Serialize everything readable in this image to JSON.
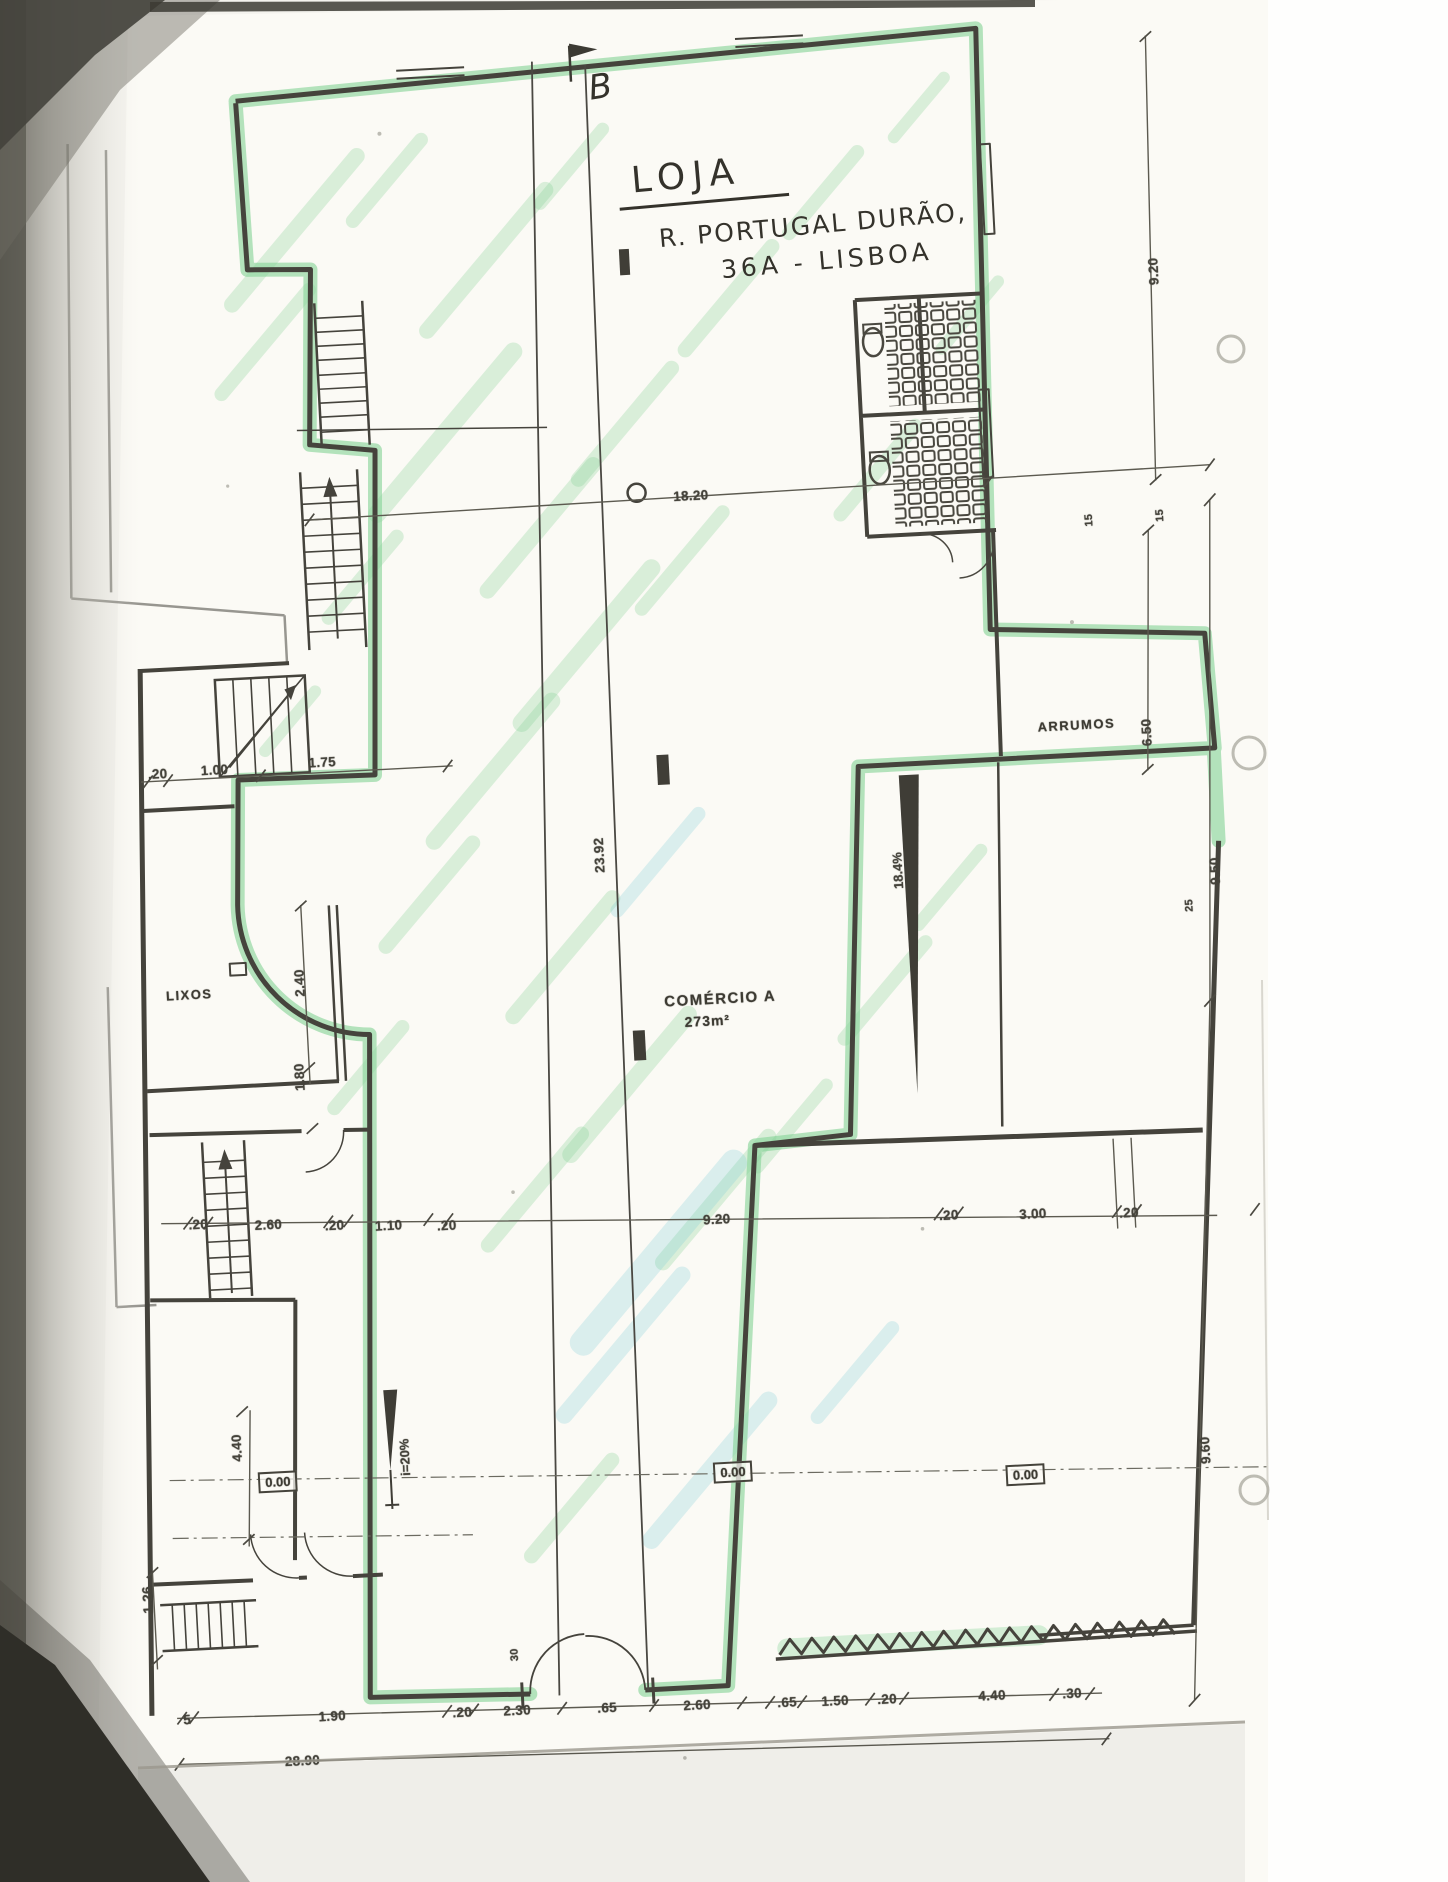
{
  "scan": {
    "section_marker": "B"
  },
  "title_block": {
    "line1": "LOJA",
    "line2": "R. PORTUGAL DURÃO,",
    "line3": "36A - LISBOA"
  },
  "rooms": {
    "arrumos": "ARRUMOS",
    "lixos": "LIXOS",
    "comercio": "COMÉRCIO A",
    "comercio_area": "273m²"
  },
  "levels": {
    "left": "0.00",
    "center": "0.00",
    "right": "0.00"
  },
  "slopes": {
    "entrance_ramp": "i=20%",
    "side_ramp": "18.4%"
  },
  "dimensions": {
    "total_width": "28.90",
    "labels": [
      {
        "t": "18.20",
        "x": 712,
        "y": 496,
        "g": "top-chain"
      },
      {
        "t": "9.20",
        "x": 1186,
        "y": 296,
        "r": -90,
        "g": "right"
      },
      {
        "t": "6.50",
        "x": 1155,
        "y": 756,
        "r": -90,
        "g": "right"
      },
      {
        "t": "15",
        "x": 1109,
        "y": 541,
        "r": -90,
        "s": 11,
        "g": "wc"
      },
      {
        "t": "15",
        "x": 1180,
        "y": 540,
        "r": -90,
        "s": 11,
        "g": "wc"
      },
      {
        "t": "25",
        "x": 1189,
        "y": 931,
        "r": -90,
        "s": 11,
        "g": "right"
      },
      {
        "t": "9.50",
        "x": 1216,
        "y": 898,
        "r": -90,
        "g": "right-outer"
      },
      {
        "t": "9.60",
        "x": 1176,
        "y": 1476,
        "r": -90,
        "g": "right-outer"
      },
      {
        "t": "23.92",
        "x": 602,
        "y": 850,
        "r": -90,
        "g": "center"
      },
      {
        "t": ".20",
        "x": 165,
        "y": 746,
        "g": "left-chain"
      },
      {
        "t": "1.00",
        "x": 222,
        "y": 745,
        "g": "left-chain"
      },
      {
        "t": "1.75",
        "x": 330,
        "y": 743,
        "g": "left-chain"
      },
      {
        "t": "2.40",
        "x": 296,
        "y": 962,
        "r": -90,
        "g": "lixos"
      },
      {
        "t": "1.80",
        "x": 291,
        "y": 1056,
        "r": -90,
        "g": "lixos"
      },
      {
        "t": ".20",
        "x": 182,
        "y": 1198,
        "g": "middle-chain"
      },
      {
        "t": "2.60",
        "x": 252,
        "y": 1202,
        "g": "middle-chain"
      },
      {
        "t": ".20",
        "x": 318,
        "y": 1206,
        "g": "middle-chain"
      },
      {
        "t": "1.10",
        "x": 372,
        "y": 1209,
        "g": "middle-chain"
      },
      {
        "t": ".20",
        "x": 430,
        "y": 1212,
        "g": "middle-chain"
      },
      {
        "t": "9.20",
        "x": 700,
        "y": 1220,
        "g": "middle-chain"
      },
      {
        "t": ".20",
        "x": 932,
        "y": 1228,
        "g": "middle-chain"
      },
      {
        "t": "3.00",
        "x": 1016,
        "y": 1231,
        "g": "middle-chain"
      },
      {
        "t": ".20",
        "x": 1112,
        "y": 1235,
        "g": "middle-chain"
      },
      {
        "t": "5",
        "x": 145,
        "y": 1692,
        "g": "bottom-chain"
      },
      {
        "t": "1.90",
        "x": 290,
        "y": 1696,
        "g": "bottom-chain"
      },
      {
        "t": ".20",
        "x": 420,
        "y": 1699,
        "g": "bottom-chain"
      },
      {
        "t": "2.30",
        "x": 475,
        "y": 1700,
        "g": "bottom-chain"
      },
      {
        "t": ".65",
        "x": 565,
        "y": 1702,
        "g": "bottom-chain"
      },
      {
        "t": "2.60",
        "x": 655,
        "y": 1704,
        "g": "bottom-chain"
      },
      {
        "t": ".65",
        "x": 745,
        "y": 1706,
        "g": "bottom-chain"
      },
      {
        "t": "1.50",
        "x": 793,
        "y": 1707,
        "g": "bottom-chain"
      },
      {
        "t": ".20",
        "x": 845,
        "y": 1708,
        "g": "bottom-chain"
      },
      {
        "t": "4.40",
        "x": 950,
        "y": 1710,
        "g": "bottom-chain"
      },
      {
        "t": ".30",
        "x": 1030,
        "y": 1712,
        "g": "bottom-chain"
      },
      {
        "t": "28.90",
        "x": 258,
        "y": 1739,
        "g": "total"
      },
      {
        "t": "4.40",
        "x": 209,
        "y": 1423,
        "r": -90,
        "g": "left-room"
      },
      {
        "t": "1.26",
        "x": 112,
        "y": 1570,
        "r": -90,
        "g": "left-room"
      },
      {
        "t": "30",
        "x": 476,
        "y": 1644,
        "r": -90,
        "s": 11,
        "g": "door"
      }
    ]
  }
}
